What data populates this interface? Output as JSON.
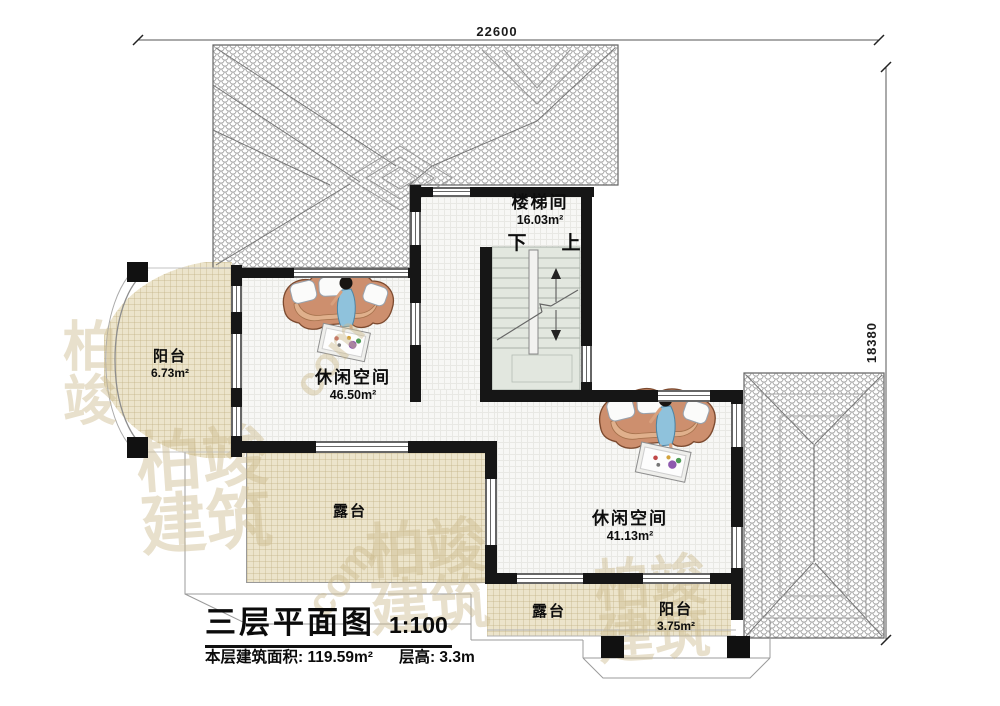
{
  "dimensions": {
    "top": "22600",
    "right": "18380"
  },
  "rooms": {
    "stairwell": {
      "name": "楼梯间",
      "area": "16.03m²"
    },
    "balcony_left": {
      "name": "阳台",
      "area": "6.73m²"
    },
    "leisure_left": {
      "name": "休闲空间",
      "area": "46.50m²"
    },
    "terrace_left": {
      "name": "露台"
    },
    "leisure_right": {
      "name": "休闲空间",
      "area": "41.13m²"
    },
    "terrace_bottom": {
      "name": "露台"
    },
    "balcony_bottom": {
      "name": "阳台",
      "area": "3.75m²"
    }
  },
  "stairs": {
    "down_label": "下",
    "up_label": "上"
  },
  "title_block": {
    "title": "三层平面图",
    "scale": "1:100",
    "floor_area": "本层建筑面积: 119.59m²",
    "floor_height": "层高: 3.3m"
  },
  "watermark": {
    "text": "柏竣建筑",
    "short": "柏竣",
    "latin": "com"
  },
  "colors": {
    "wall": "#161616",
    "floor_beige": "#ece4cb",
    "stair_fill": "#e2e7df",
    "roof_line": "#a6a6a6"
  }
}
